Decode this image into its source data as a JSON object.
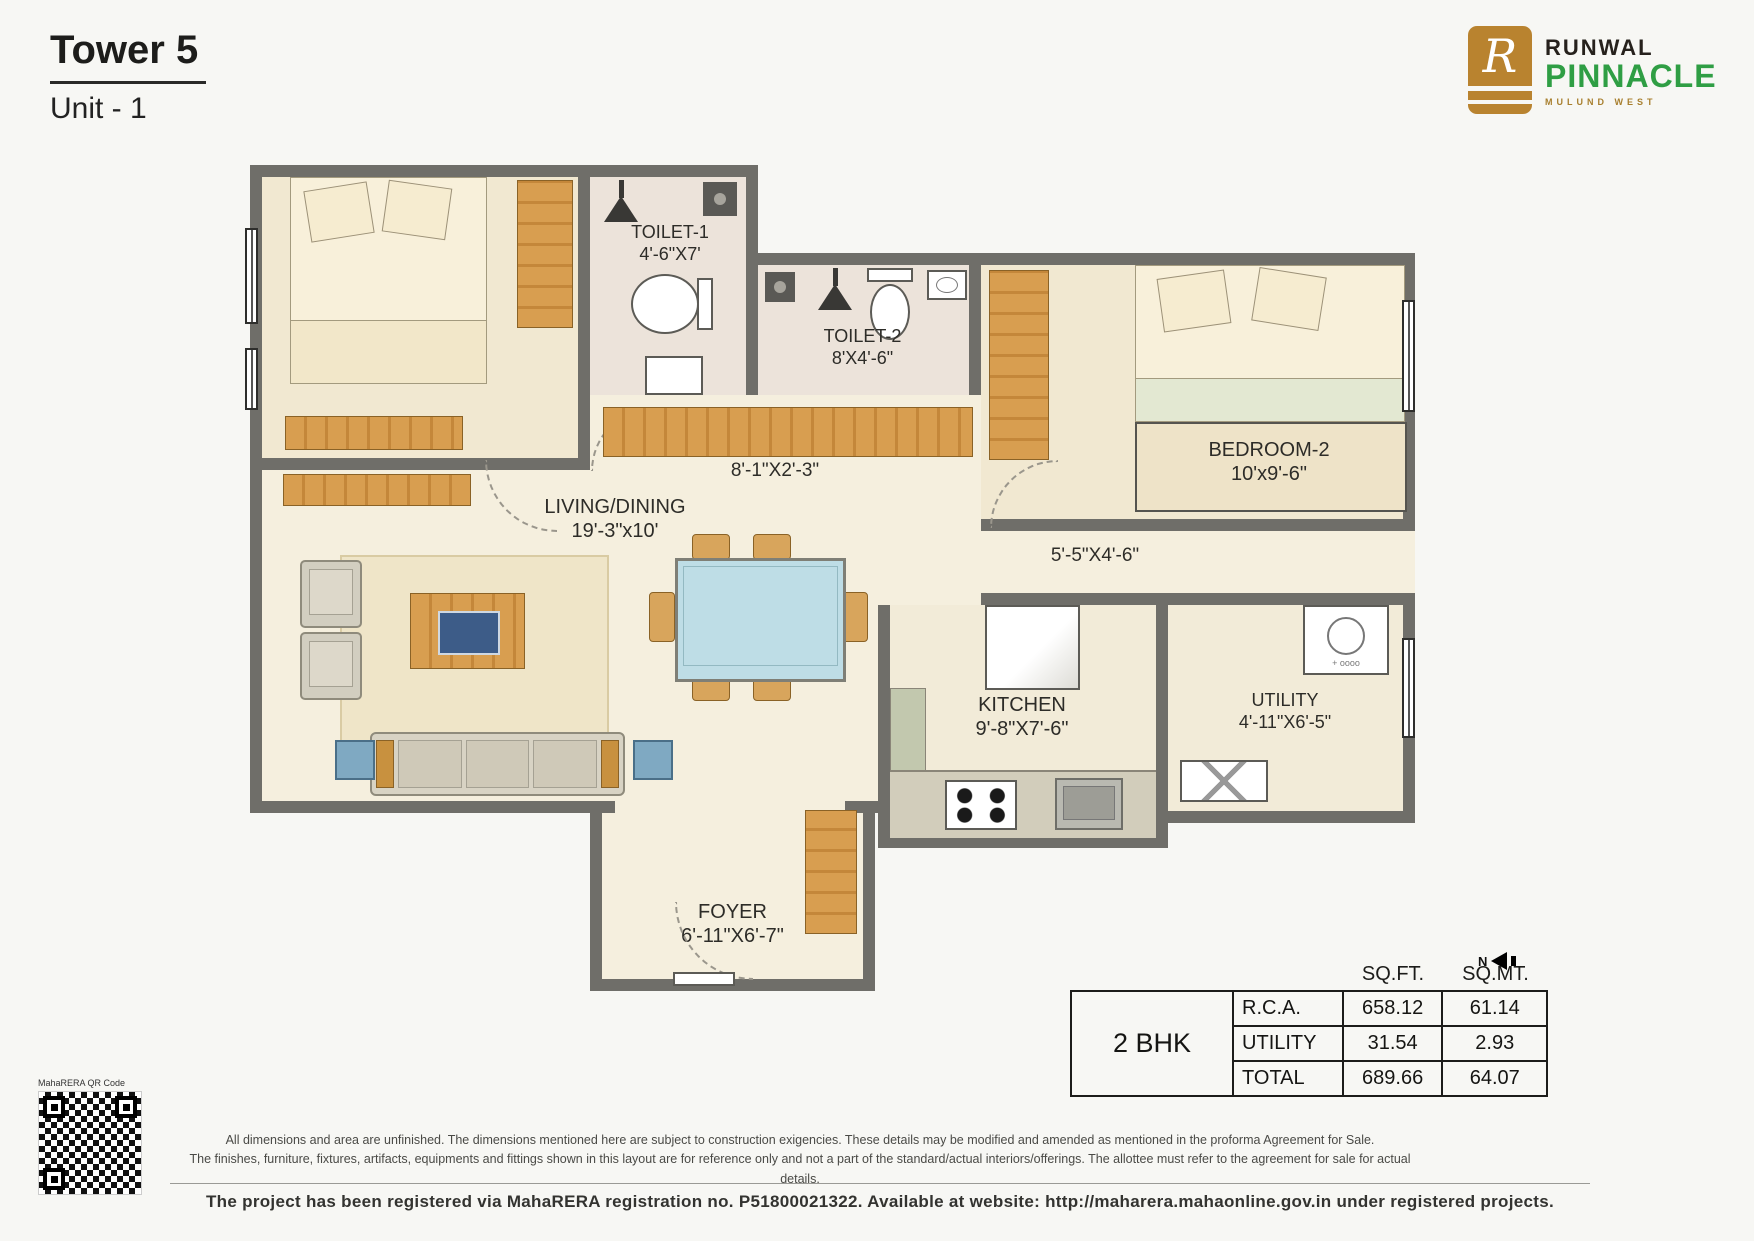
{
  "header": {
    "title": "Tower 5",
    "subtitle": "Unit - 1"
  },
  "logo": {
    "monogram": "R",
    "brand": "RUNWAL",
    "name": "PINNACLE",
    "location": "MULUND WEST",
    "gold": "#b9832f",
    "green": "#2f9e44",
    "dark": "#26211c"
  },
  "floorplan": {
    "wall_color": "#6f6e69",
    "wood_color": "#d89e50",
    "floor_color": "#f5efde",
    "rooms": [
      {
        "name": "TOILET-1",
        "dims": "4'-6\"X7'"
      },
      {
        "name": "TOILET-2",
        "dims": "8'X4'-6\""
      },
      {
        "name": "BEDROOM-2",
        "dims": "10'x9'-6\""
      },
      {
        "name": "LIVING/DINING",
        "dims": "19'-3\"x10'"
      },
      {
        "name": "KITCHEN",
        "dims": "9'-8\"X7'-6\""
      },
      {
        "name": "UTILITY",
        "dims": "4'-11\"X6'-5\""
      },
      {
        "name": "FOYER",
        "dims": "6'-11\"X6'-7\""
      }
    ],
    "passages": [
      {
        "dims": "8'-1\"X2'-3\""
      },
      {
        "dims": "5'-5\"X4'-6\""
      }
    ],
    "north_label": "N"
  },
  "area_table": {
    "unit_type": "2 BHK",
    "col_headers": [
      "SQ.FT.",
      "SQ.MT."
    ],
    "rows": [
      {
        "label": "R.C.A.",
        "sqft": "658.12",
        "sqmt": "61.14"
      },
      {
        "label": "UTILITY",
        "sqft": "31.54",
        "sqmt": "2.93"
      },
      {
        "label": "TOTAL",
        "sqft": "689.66",
        "sqmt": "64.07"
      }
    ]
  },
  "qr": {
    "label": "MahaRERA QR Code"
  },
  "footer": {
    "disclaimer_line1": "All dimensions and area are unfinished. The dimensions mentioned here are subject to construction exigencies. These details may be modified and amended as mentioned in the proforma Agreement for Sale.",
    "disclaimer_line2": "The finishes, furniture, fixtures, artifacts, equipments and fittings shown in this layout are for reference only and not a part of the standard/actual interiors/offerings. The allottee must refer to the agreement for sale for actual details.",
    "registration": "The project has been registered via MahaRERA registration no. P51800021322. Available at website: http://maharera.mahaonline.gov.in under registered projects."
  }
}
